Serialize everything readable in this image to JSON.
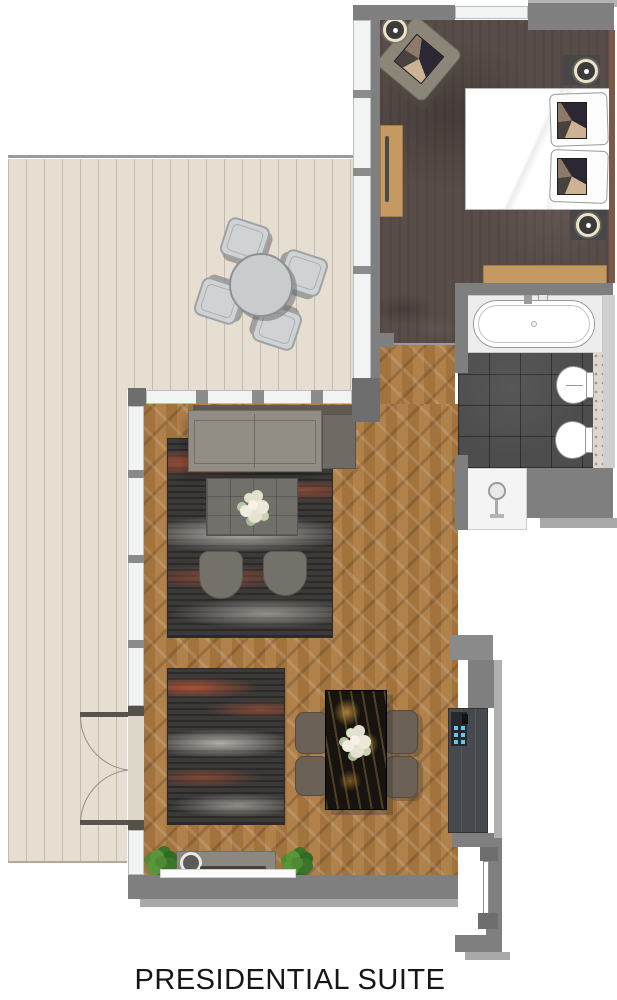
{
  "title": "PRESIDENTIAL SUITE",
  "colors": {
    "wall": "#7f7f7f",
    "wall_light": "#a9a9a9",
    "deck": "#e6dfd1",
    "wood_floor": "#ad7a41",
    "bedroom_carpet": "#594d49",
    "bathroom_tile": "#4d4d4d",
    "accent_wood": "#c59a62",
    "wardrobe": "#46494d",
    "minibar_blue": "#63c8ee",
    "rug_rust": "#b85538",
    "plant_green": "#4e8a34",
    "fixture_white": "#ffffff"
  }
}
